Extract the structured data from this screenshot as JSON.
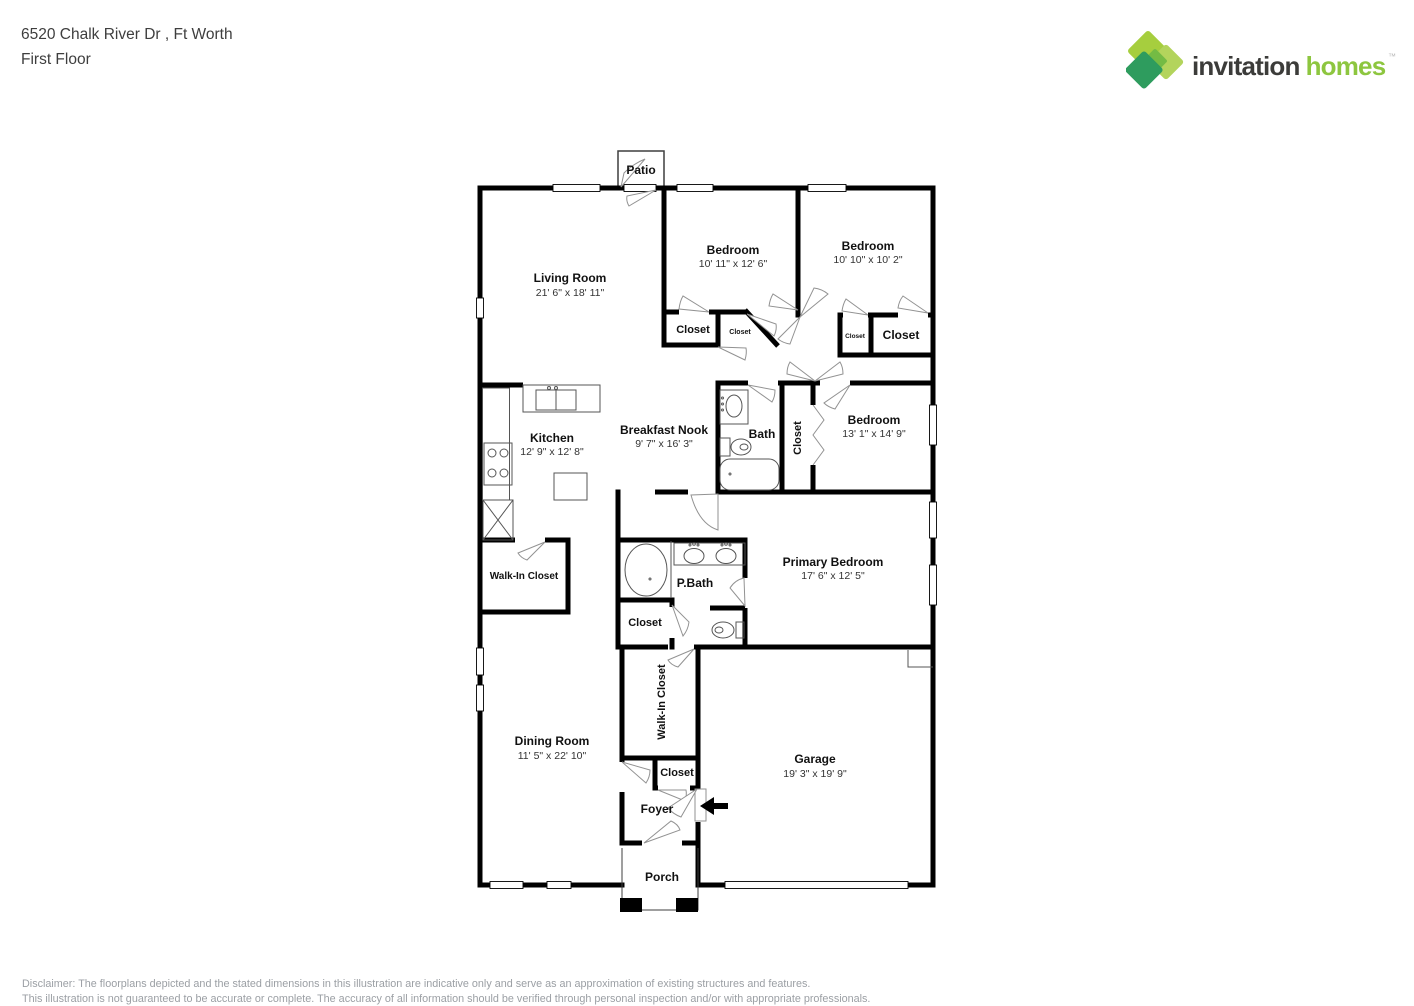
{
  "header": {
    "address": "6520 Chalk River Dr , Ft Worth",
    "floor": "First Floor"
  },
  "logo": {
    "brand_invitation": "invitation",
    "brand_homes": "homes",
    "trademark": "™",
    "colors": {
      "diamond_light": "#A6CE3E",
      "diamond_pale": "#B3D45C",
      "diamond_mid": "#74BB44",
      "diamond_dark": "#2E9C5E",
      "text_dark": "#3C3C3A",
      "text_green": "#8DC63F"
    }
  },
  "floorplan": {
    "rooms": [
      {
        "id": "living-room",
        "name": "Living Room",
        "dims": "21' 6\" x 18' 11\""
      },
      {
        "id": "bedroom-1",
        "name": "Bedroom",
        "dims": "10' 11\" x 12' 6\""
      },
      {
        "id": "bedroom-2",
        "name": "Bedroom",
        "dims": "10' 10\" x 10' 2\""
      },
      {
        "id": "bedroom-3",
        "name": "Bedroom",
        "dims": "13' 1\" x 14' 9\""
      },
      {
        "id": "kitchen",
        "name": "Kitchen",
        "dims": "12' 9\" x 12' 8\""
      },
      {
        "id": "breakfast-nook",
        "name": "Breakfast Nook",
        "dims": "9' 7\" x 16' 3\""
      },
      {
        "id": "bath",
        "name": "Bath"
      },
      {
        "id": "primary-bedroom",
        "name": "Primary Bedroom",
        "dims": "17' 6\" x 12' 5\""
      },
      {
        "id": "p-bath",
        "name": "P.Bath"
      },
      {
        "id": "dining-room",
        "name": "Dining Room",
        "dims": "11' 5\" x 22' 10\""
      },
      {
        "id": "garage",
        "name": "Garage",
        "dims": "19' 3\" x 19' 9\""
      },
      {
        "id": "patio",
        "name": "Patio"
      },
      {
        "id": "foyer",
        "name": "Foyer"
      },
      {
        "id": "porch",
        "name": "Porch"
      },
      {
        "id": "walk-in-closet-main",
        "name": "Walk-In Closet"
      },
      {
        "id": "walk-in-closet-foyer",
        "name": "Walk-In Closet"
      },
      {
        "id": "closet-bedroom1",
        "name": "Closet"
      },
      {
        "id": "closet-bedroom1-small",
        "name": "Closet"
      },
      {
        "id": "closet-bedroom2-small",
        "name": "Closet"
      },
      {
        "id": "closet-bedroom2",
        "name": "Closet"
      },
      {
        "id": "closet-hall-bath",
        "name": "Closet"
      },
      {
        "id": "closet-pbath",
        "name": "Closet"
      },
      {
        "id": "closet-foyer",
        "name": "Closet"
      }
    ]
  },
  "disclaimer": {
    "line1": "Disclaimer: The floorplans depicted and the stated dimensions in this illustration are indicative only and serve as an approximation of existing structures and features.",
    "line2": "This illustration is not guaranteed to be accurate or complete. The accuracy of all information should be verified through personal inspection and/or with appropriate professionals."
  }
}
